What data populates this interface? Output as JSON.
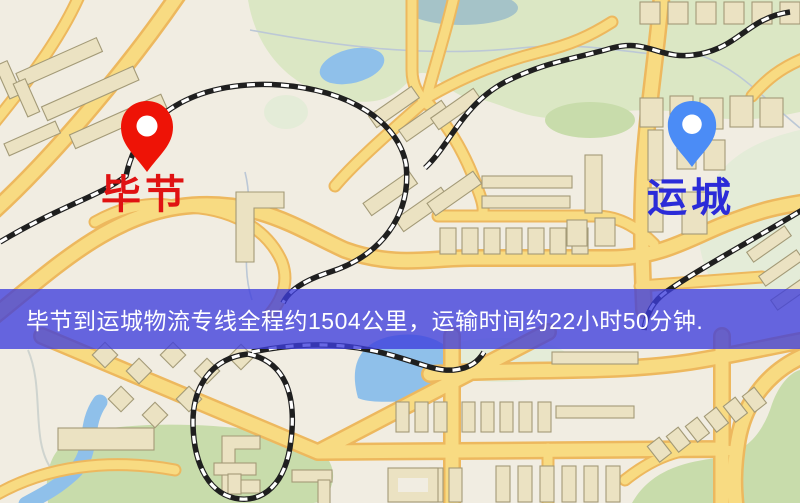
{
  "map": {
    "origin": {
      "name": "毕节",
      "pin_color": "#ee1306",
      "label_color": "#e01212"
    },
    "destination": {
      "name": "运城",
      "pin_color": "#4b8cf6",
      "label_color": "#2b2bd8"
    },
    "banner": {
      "text": "毕节到运城物流专线全程约1504公里，运输时间约22小时50分钟.",
      "distance_km": "1504",
      "duration": "22小时50分钟"
    }
  },
  "css_vars": {
    "land": "#f1ede2",
    "park": "#dbe7c4",
    "park-dark": "#c8dcab",
    "park-pale": "#e4ecd8",
    "water": "#8fc0ea",
    "pond": "#a5c3c8",
    "road": "#f8db82",
    "road-casing": "#edb85e",
    "building": "#ebe2c2",
    "building-stroke": "#a39a77",
    "rail": "#1f1f1f",
    "pin-red": "#ee1306",
    "pin-blue": "#4b8cf6",
    "label-red": "#e01212",
    "label-blue": "#2b2bd8",
    "banner-bg": "rgba(62,62,220,0.78)",
    "banner-text": "#ffffff"
  }
}
